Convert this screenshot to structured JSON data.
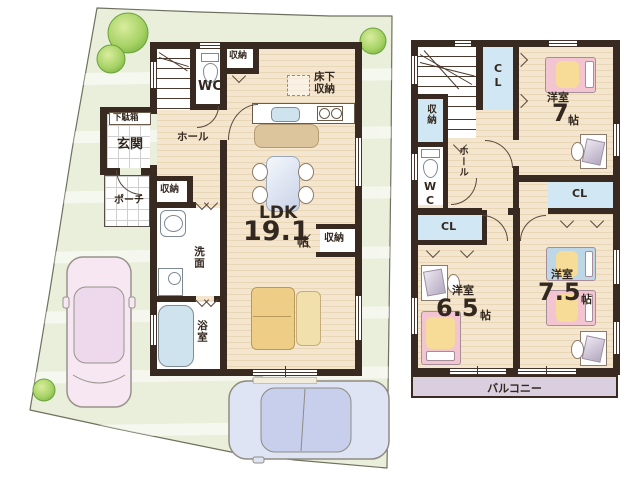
{
  "floor1": {
    "wc": "WC",
    "closet_top": "収納",
    "underfloor_1": "床下",
    "underfloor_2": "収納",
    "shoe_cabinet": "下駄箱",
    "entrance": "玄関",
    "hall": "ホール",
    "porch": "ポーチ",
    "closet_hall": "収納",
    "ldk_label": "LDK",
    "ldk_size": "19.1",
    "ldk_unit": "帖",
    "closet_ldk": "収納",
    "washroom": "洗面",
    "bathroom": "浴室"
  },
  "floor2": {
    "cl_top": "CL",
    "closet": "収納",
    "wc": "WC",
    "hall": "ホール",
    "cl_left": "CL",
    "cl_right": "CL",
    "room7_label": "洋室",
    "room7_size": "7",
    "room7_unit": "帖",
    "room65_label": "洋室",
    "room65_size": "6.5",
    "room65_unit": "帖",
    "room75_label": "洋室",
    "room75_size": "7.5",
    "room75_unit": "帖",
    "balcony": "バルコニー"
  },
  "palette": {
    "wall": "#382a21",
    "floor_wood": "#f4e6ce",
    "site_green": "#e9efdb",
    "closet_blue": "#d2e7f4",
    "balcony_lavender": "#d9cfdf",
    "bed_pink": "#f3c5d1",
    "bed_blue": "#bdd7e7",
    "blanket_yellow": "#f6dc96",
    "sofa_tan": "#eece86",
    "car_pink": "#f6e7f3",
    "car_blue": "#dfe4f4",
    "tree_green": "#8cbf54"
  }
}
